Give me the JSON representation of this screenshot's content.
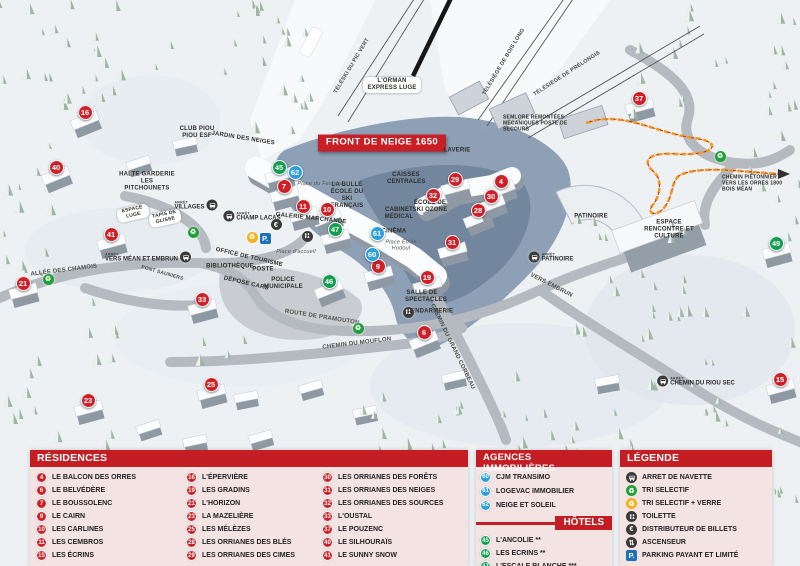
{
  "colors": {
    "red": "#cf2027",
    "blue": "#2ba0da",
    "green": "#0f9f4f",
    "header_red": "#c41e24",
    "panel_pink": "#f4e3e3"
  },
  "map": {
    "arret_word": "ARRÊT",
    "front_banner": "FRONT DE NEIGE 1650",
    "labels": [
      {
        "t": "FRONT DE NEIGE 1650",
        "x": 382,
        "y": 143,
        "cls": "banner"
      },
      {
        "t": "TÉLÉSKI DU PIC VERT",
        "x": 352,
        "y": 66,
        "r": -59,
        "cls": "lift"
      },
      {
        "t": "TÉLÉSIÈGE DE BOIS LONG",
        "x": 504,
        "y": 62,
        "r": -59,
        "cls": "lift"
      },
      {
        "t": "TÉLÉSIÈGE DE PRÉLONGIS",
        "x": 567,
        "y": 74,
        "r": -33,
        "cls": "lift"
      },
      {
        "t": "L'ORMAN EXPRESS LUGE",
        "x": 392,
        "y": 85,
        "cls": "pill multi",
        "w": 52
      },
      {
        "t": "SEMLORE REMONTÉES MÉCANIQUES POSTE DE SECOURS",
        "x": 503,
        "y": 124,
        "cls": "left multi tiny2",
        "w": 78
      },
      {
        "t": "CHEMIN PIÉTONNIER VERS LES ORRES 1800 BOIS MÉAN",
        "x": 722,
        "y": 184,
        "cls": "left multi tiny2",
        "w": 62
      },
      {
        "t": "CLUB PIOU PIOU ESF",
        "x": 197,
        "y": 133,
        "cls": "multi",
        "w": 44
      },
      {
        "t": "JARDIN DES NEIGES",
        "x": 243,
        "y": 139,
        "r": 9
      },
      {
        "t": "HALTE GARDERIE LES PITCHOUNETS",
        "x": 147,
        "y": 182,
        "cls": "multi",
        "w": 58
      },
      {
        "t": "ESPACE LUGE",
        "x": 133,
        "y": 213,
        "r": -12,
        "cls": "pill multi tiny2",
        "w": 26
      },
      {
        "t": "TAPIS DE GLISSE",
        "x": 165,
        "y": 218,
        "r": -12,
        "cls": "pill multi tiny2",
        "w": 26
      },
      {
        "t": "LA BULLE ÉCOLE DU SKI FRANÇAIS",
        "x": 347,
        "y": 196,
        "cls": "multi",
        "w": 44
      },
      {
        "t": "Place du Festival",
        "x": 320,
        "y": 184,
        "cls": "italic"
      },
      {
        "t": "GALERIE MARCHANDE",
        "x": 311,
        "y": 219,
        "r": 6
      },
      {
        "t": "CAISSES CENTRALES",
        "x": 406,
        "y": 179,
        "cls": "multi",
        "w": 38
      },
      {
        "t": "LAVERIE",
        "x": 457,
        "y": 151
      },
      {
        "t": "ÉCOLE DE SKI OZONE",
        "x": 430,
        "y": 207,
        "cls": "multi",
        "w": 38
      },
      {
        "t": "CABINET MÉDICAL",
        "x": 399,
        "y": 214,
        "cls": "multi",
        "w": 34
      },
      {
        "t": "CINÉMA",
        "x": 394,
        "y": 232
      },
      {
        "t": "Place Émile Hodoul",
        "x": 401,
        "y": 246,
        "cls": "italic multi",
        "w": 34
      },
      {
        "t": "OFFICE DE TOURISME",
        "x": 249,
        "y": 258,
        "r": 13
      },
      {
        "t": "BIBLIOTHÈQUE",
        "x": 230,
        "y": 267
      },
      {
        "t": "POSTE",
        "x": 263,
        "y": 270
      },
      {
        "t": "DÉPOSE CARS",
        "x": 246,
        "y": 284,
        "r": 13
      },
      {
        "t": "POLICE MUNICIPALE",
        "x": 283,
        "y": 284,
        "cls": "multi",
        "w": 38
      },
      {
        "t": "Place d'accueil",
        "x": 296,
        "y": 252,
        "cls": "italic"
      },
      {
        "t": "SALLE DE SPECTACLES",
        "x": 422,
        "y": 297,
        "cls": "multi",
        "w": 34
      },
      {
        "t": "GENDARMERIE",
        "x": 426,
        "y": 312,
        "cls": "multi",
        "w": 40
      },
      {
        "t": "PATINOIRE",
        "x": 591,
        "y": 217
      },
      {
        "t": "ESPACE RENCONTRE ET CULTURE",
        "x": 669,
        "y": 230,
        "cls": "multi",
        "w": 54
      },
      {
        "t": "ALLÉE DES CHAMOIS",
        "x": 64,
        "y": 271,
        "r": -7,
        "cls": "road"
      },
      {
        "t": "PONT SAUNIERS",
        "x": 162,
        "y": 274,
        "r": 16,
        "cls": "road tiny2"
      },
      {
        "t": "ROUTE DE PRAMOUTON",
        "x": 322,
        "y": 318,
        "r": 9,
        "cls": "road"
      },
      {
        "t": "CHEMIN DU MOUFLON",
        "x": 357,
        "y": 344,
        "r": -7,
        "cls": "road"
      },
      {
        "t": "CHEMIN DU GRAND CORBEAU",
        "x": 452,
        "y": 347,
        "r": 64,
        "cls": "road"
      },
      {
        "t": "VERS EMBRUN",
        "x": 551,
        "y": 286,
        "r": 27,
        "cls": "road"
      }
    ],
    "bus_stops": [
      {
        "label": "VILLAGES",
        "x": 196,
        "y": 205,
        "side": "right"
      },
      {
        "label": "CHAMP LACAS",
        "x": 252,
        "y": 216,
        "side": "left"
      },
      {
        "label": "VERS MÉAN ET EMBRUN",
        "x": 148,
        "y": 257,
        "side": "right"
      },
      {
        "label": "PATINOIRE",
        "x": 551,
        "y": 257,
        "side": "left"
      },
      {
        "label": "CHEMIN DU RIOU SEC",
        "x": 696,
        "y": 381,
        "side": "left"
      }
    ],
    "amenities": [
      {
        "type": "tri",
        "x": 48,
        "y": 279
      },
      {
        "type": "tri",
        "x": 193,
        "y": 232
      },
      {
        "type": "tri",
        "x": 358,
        "y": 328
      },
      {
        "type": "tri",
        "x": 720,
        "y": 156
      },
      {
        "type": "tri-verre",
        "x": 252,
        "y": 237
      },
      {
        "type": "parking",
        "x": 265,
        "y": 238
      },
      {
        "type": "euro",
        "x": 276,
        "y": 224
      },
      {
        "type": "toilette",
        "x": 307,
        "y": 236
      },
      {
        "type": "toilette",
        "x": 408,
        "y": 312
      }
    ],
    "markers": [
      {
        "n": 4,
        "c": "r",
        "x": 501,
        "y": 181
      },
      {
        "n": 6,
        "c": "r",
        "x": 424,
        "y": 332
      },
      {
        "n": 7,
        "c": "r",
        "x": 284,
        "y": 186
      },
      {
        "n": 9,
        "c": "r",
        "x": 378,
        "y": 266
      },
      {
        "n": 10,
        "c": "r",
        "x": 327,
        "y": 209
      },
      {
        "n": 11,
        "c": "r",
        "x": 303,
        "y": 206
      },
      {
        "n": 15,
        "c": "r",
        "x": 780,
        "y": 379
      },
      {
        "n": 16,
        "c": "r",
        "x": 85,
        "y": 112
      },
      {
        "n": 19,
        "c": "r",
        "x": 427,
        "y": 277
      },
      {
        "n": 21,
        "c": "r",
        "x": 23,
        "y": 283
      },
      {
        "n": 23,
        "c": "r",
        "x": 88,
        "y": 400
      },
      {
        "n": 25,
        "c": "r",
        "x": 211,
        "y": 384
      },
      {
        "n": 28,
        "c": "r",
        "x": 478,
        "y": 210
      },
      {
        "n": 29,
        "c": "r",
        "x": 455,
        "y": 179
      },
      {
        "n": 30,
        "c": "r",
        "x": 491,
        "y": 196
      },
      {
        "n": 31,
        "c": "r",
        "x": 452,
        "y": 242
      },
      {
        "n": 32,
        "c": "r",
        "x": 433,
        "y": 195
      },
      {
        "n": 33,
        "c": "r",
        "x": 202,
        "y": 299
      },
      {
        "n": 37,
        "c": "r",
        "x": 639,
        "y": 98
      },
      {
        "n": 40,
        "c": "r",
        "x": 56,
        "y": 167
      },
      {
        "n": 41,
        "c": "r",
        "x": 111,
        "y": 234
      },
      {
        "n": 60,
        "c": "b",
        "x": 372,
        "y": 254
      },
      {
        "n": 61,
        "c": "b",
        "x": 377,
        "y": 233
      },
      {
        "n": 62,
        "c": "b",
        "x": 295,
        "y": 172
      },
      {
        "n": 45,
        "c": "g",
        "x": 279,
        "y": 167
      },
      {
        "n": 46,
        "c": "g",
        "x": 329,
        "y": 281
      },
      {
        "n": 47,
        "c": "g",
        "x": 335,
        "y": 229
      },
      {
        "n": 49,
        "c": "g",
        "x": 776,
        "y": 243
      }
    ]
  },
  "panels": {
    "residences": {
      "title": "RÉSIDENCES",
      "items": [
        {
          "n": 4,
          "label": "LE BALCON DES ORRES"
        },
        {
          "n": 6,
          "label": "LE BELVÉDÈRE"
        },
        {
          "n": 7,
          "label": "LE BOUSSOLENC"
        },
        {
          "n": 9,
          "label": "LE CAIRN"
        },
        {
          "n": 10,
          "label": "LES CARLINES"
        },
        {
          "n": 11,
          "label": "LES CEMBROS"
        },
        {
          "n": 15,
          "label": "LES ÉCRINS"
        },
        {
          "n": 16,
          "label": "L'ÉPERVIÈRE"
        },
        {
          "n": 19,
          "label": "LES GRADINS"
        },
        {
          "n": 21,
          "label": "L'HORIZON"
        },
        {
          "n": 23,
          "label": "LA MAZELIÈRE"
        },
        {
          "n": 25,
          "label": "LES MÉLÈZES"
        },
        {
          "n": 28,
          "label": "LES ORRIANES DES BLÉS"
        },
        {
          "n": 29,
          "label": "LES ORRIANES DES CIMES"
        },
        {
          "n": 30,
          "label": "LES ORRIANES DES FORÊTS"
        },
        {
          "n": 31,
          "label": "LES ORRIANES DES NEIGES"
        },
        {
          "n": 32,
          "label": "LES ORRIANES DES SOURCES"
        },
        {
          "n": 33,
          "label": "L'OUSTAL"
        },
        {
          "n": 37,
          "label": "LE POUZENC"
        },
        {
          "n": 40,
          "label": "LE SILHOURAÏS"
        },
        {
          "n": 41,
          "label": "LE SUNNY SNOW"
        }
      ]
    },
    "agences": {
      "title": "AGENCES IMMOBILIÈRES",
      "items": [
        {
          "n": 60,
          "label": "CJM TRANSIMO"
        },
        {
          "n": 61,
          "label": "LOGEVAC IMMOBILIER"
        },
        {
          "n": 62,
          "label": "NEIGE ET SOLEIL"
        }
      ]
    },
    "hotels": {
      "title": "HÔTELS",
      "items": [
        {
          "n": 45,
          "label": "L'ANCOLIE **"
        },
        {
          "n": 46,
          "label": "LES ECRINS **"
        },
        {
          "n": 47,
          "label": "L'ESCALE BLANCHE ***"
        },
        {
          "n": 49,
          "label": "LES TRAPPEURS **"
        }
      ]
    },
    "legende": {
      "title": "LÉGENDE",
      "items": [
        {
          "icon": "navette",
          "label": "ARRET DE NAVETTE"
        },
        {
          "icon": "tri",
          "label": "TRI SELECTIF"
        },
        {
          "icon": "tri-verre",
          "label": "TRI SELECTIF + VERRE"
        },
        {
          "icon": "toilette",
          "label": "TOILETTE"
        },
        {
          "icon": "euro",
          "label": "DISTRIBUTEUR DE BILLETS"
        },
        {
          "icon": "ascenseur",
          "label": "ASCENSEUR"
        },
        {
          "icon": "parking",
          "label": "PARKING PAYANT ET LIMITÉ"
        }
      ]
    }
  }
}
